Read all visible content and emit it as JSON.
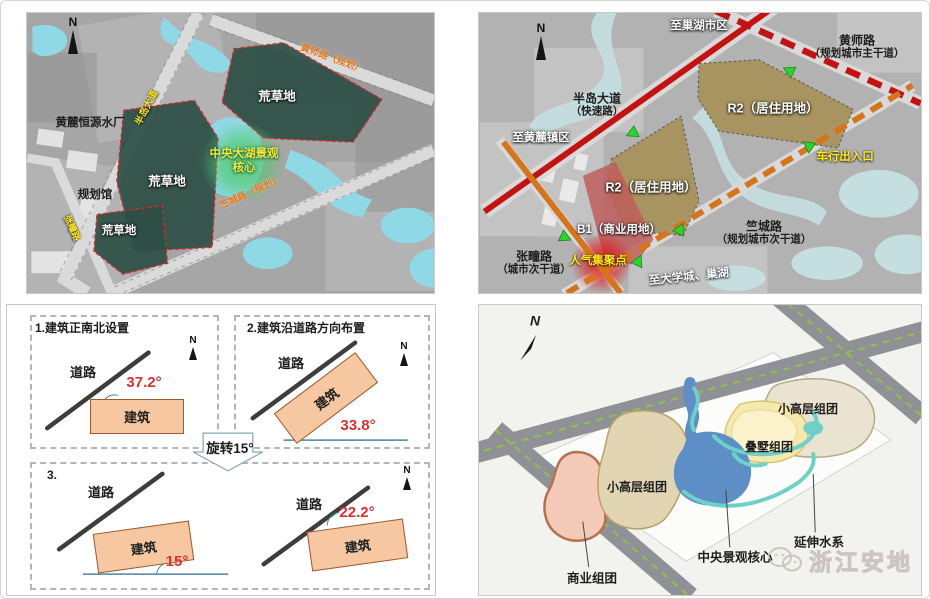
{
  "colors": {
    "expressway_red": "#c21212",
    "planned_road_orange": "#d4741c",
    "wasteland_green": "#2d4f45",
    "residential_brown": "#a8925c",
    "commercial_red": "#c05a5a",
    "water_cyan": "#8fd9e6",
    "lake_blue": "#5d8ec6",
    "building_peach": "#f6c7a0",
    "angle_red": "#d93030",
    "highlight_yellow": "#ffe81a",
    "arrow_green": "#2fd32f"
  },
  "panels": {
    "site_context": {
      "compass": "N",
      "labels": {
        "water_plant": "黄麓恒源水厂",
        "planning_hall": "规划馆",
        "wasteland_a": "荒草地",
        "wasteland_b": "荒草地",
        "wasteland_c": "荒草地",
        "lake_core_line1": "中央大湖景观",
        "lake_core_line2": "核心",
        "road_bandao": "半岛大道",
        "road_huangshi": "黄师路（规划）",
        "road_zhucheng": "竺城路（规划）",
        "road_zhangtuan": "张疃路"
      }
    },
    "road_planning": {
      "compass": "N",
      "labels": {
        "to_chaohu": "至巢湖市区",
        "huangshi_name": "黄师路",
        "huangshi_class": "（规划城市主干道）",
        "bandao_name": "半岛大道",
        "bandao_class": "（快速路）",
        "to_huanglu": "至黄麓镇区",
        "r2_right": "R2（居住用地）",
        "r2_left": "R2（居住用地）",
        "b1": "B1（商业用地）",
        "vehicle_access": "车行出入口",
        "zhucheng_name": "竺城路",
        "zhucheng_class": "（规划城市次干道）",
        "zhangtuan_name": "张疃路",
        "zhangtuan_class": "（城市次干道）",
        "popularity_node": "人气集聚点",
        "to_university": "至大学城、巢湖"
      }
    },
    "rotation_study": {
      "compass": "N",
      "box1_title": "1.建筑正南北设置",
      "box2_title": "2.建筑沿道路方向布置",
      "box3_title": "3.",
      "road_label": "道路",
      "building_label": "建筑",
      "rotate_note": "旋转15°",
      "angles": [
        "37.2°",
        "33.8°",
        "15°",
        "22.2°"
      ]
    },
    "concept_plan": {
      "compass": "N",
      "labels": {
        "highrise_west": "小高层组团",
        "highrise_east": "小高层组团",
        "stacked_villa": "叠墅组团",
        "central_core": "中央景观核心",
        "water_system": "延伸水系",
        "commercial": "商业组团"
      },
      "watermark": "浙江安地"
    }
  }
}
